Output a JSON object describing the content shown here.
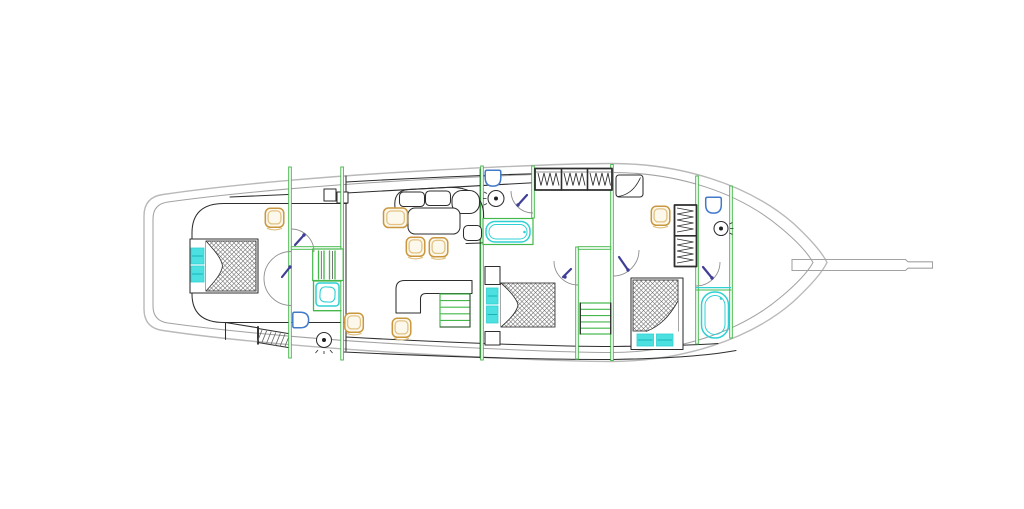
{
  "title": "Motor sailing yacht — lower deck floor plan (line drawing)",
  "canvas": {
    "width": 1024,
    "height": 509,
    "background": "#ffffff"
  },
  "colors": {
    "wall_green": "#44b84a",
    "fixture_cyan": "#2fd0d4",
    "fixture_cyan_fill": "#4ce0e0",
    "fixture_cyan_dark": "#17b3b3",
    "furniture_tan": "#c9973f",
    "furniture_tan_light": "#e2c384",
    "furniture_fill": "#fdf8ec",
    "plumbing_blue": "#4279c9",
    "door_navy": "#3f3f96",
    "line_dark": "#2e2e2e",
    "hull_gray": "#b9b9b9",
    "hull_gray_inner": "#a2a2a2",
    "hatch_line": "#636363",
    "arc_gray": "#8f8f8f"
  },
  "vessel": {
    "drawing_type": "deck floor plan, plan view, no text labels",
    "orientation": "bow to the right, stern to the left",
    "areas": [
      {
        "name": "aft-cabin",
        "fixtures": [
          "double-bed",
          "bed-pillows",
          "armchair"
        ]
      },
      {
        "name": "aft-landing",
        "fixtures": [
          "staircase",
          "shower",
          "toilet",
          "washbasin",
          "swing-door",
          "swing-door",
          "deck-hatch-steps"
        ]
      },
      {
        "name": "salon",
        "fixtures": [
          "corner-sofa",
          "dining-table",
          "armchair",
          "chair",
          "chair",
          "galley-counter",
          "galley-shelves",
          "chair",
          "chair",
          "storage-boxes"
        ]
      },
      {
        "name": "mid-bathroom",
        "fixtures": [
          "toilet",
          "washbasin",
          "bathtub",
          "swing-door"
        ]
      },
      {
        "name": "mid-cabin",
        "fixtures": [
          "double-bed",
          "bed-pillows",
          "hanging-wardrobe",
          "nightstand",
          "nightstand"
        ]
      },
      {
        "name": "stairwell",
        "fixtures": [
          "staircase",
          "swing-door",
          "swing-door"
        ]
      },
      {
        "name": "forward-cabin",
        "fixtures": [
          "double-bed",
          "bed-pillows",
          "hanging-wardrobe",
          "vanity-seat",
          "stool",
          "swing-door"
        ]
      },
      {
        "name": "forward-bathroom",
        "fixtures": [
          "toilet",
          "washbasin",
          "bathtub",
          "swing-door"
        ]
      },
      {
        "name": "exterior",
        "fixtures": [
          "hull-outline",
          "bulwark-line",
          "bowsprit"
        ]
      }
    ]
  }
}
